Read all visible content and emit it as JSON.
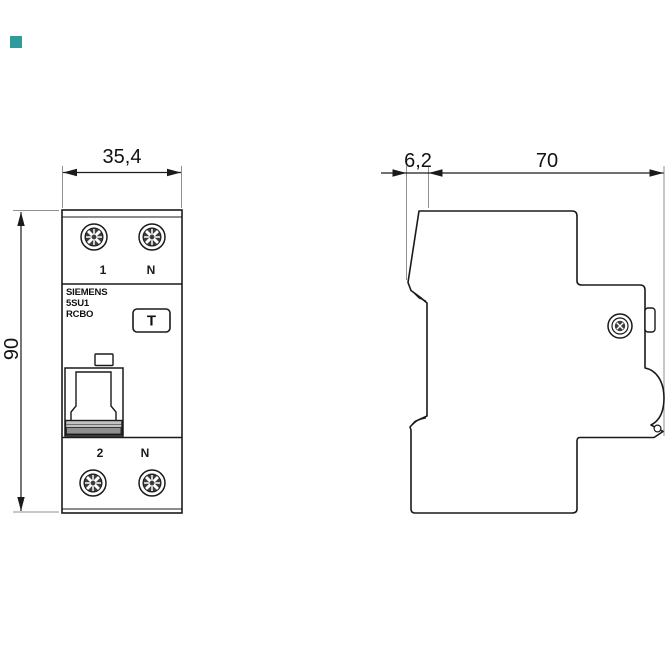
{
  "brand_square": {
    "color": "#2E9C9C"
  },
  "colors": {
    "line": "#1a1a1a",
    "extension_line": "#8f8f8f",
    "switch_grip_fill": "#c2c2c2",
    "switch_grip_dark": "#8f8f8f",
    "screw_slot_dark": "#3d3d3d"
  },
  "front_view": {
    "dimension_width_mm": "35,4",
    "dimension_height_mm": "90",
    "terminals_top": [
      "1",
      "N"
    ],
    "terminals_bottom": [
      "2",
      "N"
    ],
    "product_label_lines": [
      "SIEMENS",
      "5SU1",
      "RCBO"
    ],
    "test_button_label": "T"
  },
  "side_view": {
    "dimension_front_depth_mm": "6,2",
    "dimension_total_depth_mm": "70"
  }
}
